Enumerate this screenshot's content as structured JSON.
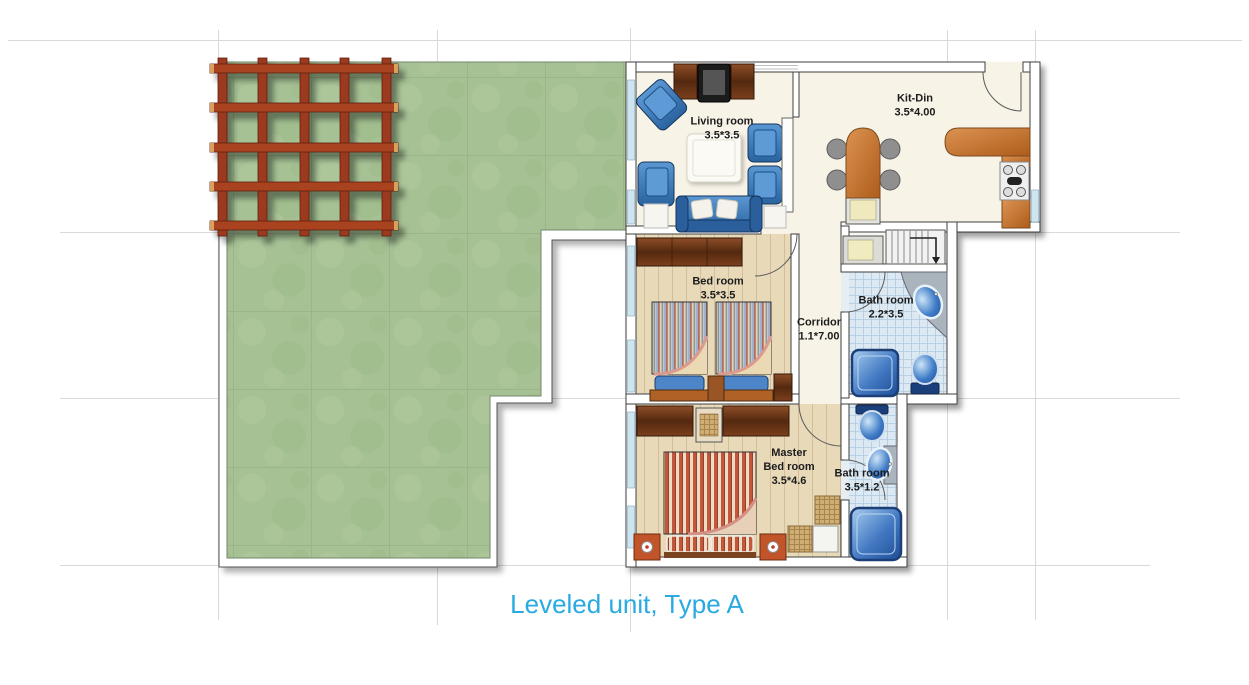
{
  "caption": {
    "text": "Leveled unit, Type A"
  },
  "rooms": {
    "living": {
      "name": "Living room",
      "dims": "3.5*3.5"
    },
    "kitdin": {
      "name": "Kit-Din",
      "dims": "3.5*4.00"
    },
    "bedroom": {
      "name": "Bed room",
      "dims": "3.5*3.5"
    },
    "corridor": {
      "name": "Corridor",
      "dims": "1.1*7.00"
    },
    "bath1": {
      "name": "Bath room",
      "dims": "2.2*3.5"
    },
    "master": {
      "name": "Master",
      "name2": "Bed room",
      "dims": "3.5*4.6"
    },
    "bath2": {
      "name": "Bath room",
      "dims": "3.5*1.2"
    }
  },
  "colors": {
    "caption_blue": "#29aae1",
    "lawn_green": "#a6c295",
    "pergola_red": "#9c3a20",
    "furniture_blue": "#3b7fc4",
    "counter_wood": "#c97a3d",
    "tile_blue": "#dce9f2",
    "floor_wood": "#e8dab9",
    "floor_cream": "#f8f3e7"
  }
}
